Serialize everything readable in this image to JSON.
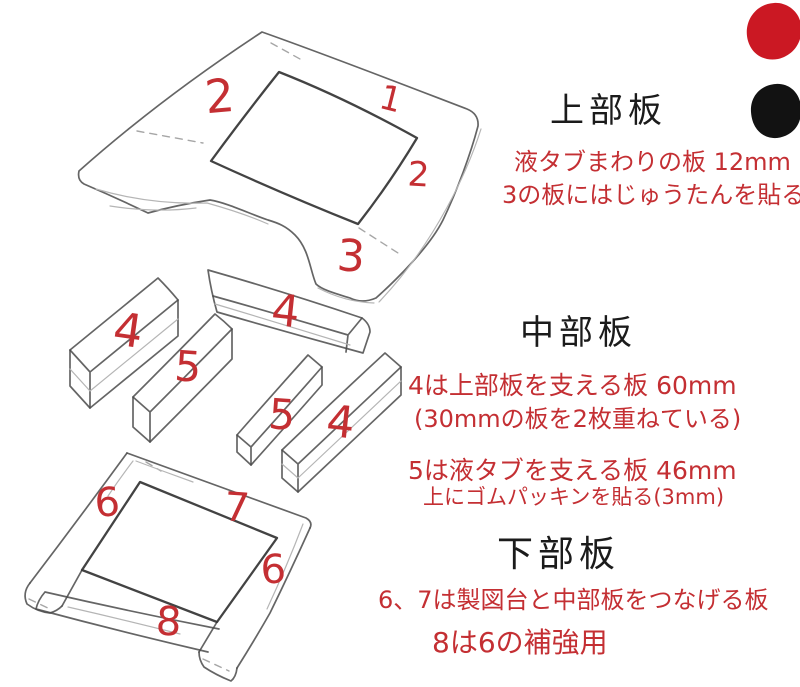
{
  "palette": {
    "background": "#ffffff",
    "pencil": "#4a4a4a",
    "pencil_bold": "#2f2f2f",
    "pencil_light": "#b5b5b5",
    "red_marker": "#c42f33",
    "ink_black": "#1b1b1b",
    "swatch_red": "#cb1823",
    "swatch_black": "#121212"
  },
  "swatches": {
    "red_blob": "red-paint-blob",
    "black_blob": "black-paint-blob"
  },
  "part_labels": [
    {
      "part": "top-board-1",
      "text": "1"
    },
    {
      "part": "top-board-2-left",
      "text": "2"
    },
    {
      "part": "top-board-2-right",
      "text": "2"
    },
    {
      "part": "top-board-3",
      "text": "3"
    },
    {
      "part": "mid-bar-4-left",
      "text": "4"
    },
    {
      "part": "mid-bar-5-left",
      "text": "5"
    },
    {
      "part": "mid-bar-4-cross",
      "text": "4"
    },
    {
      "part": "mid-bar-5-right",
      "text": "5"
    },
    {
      "part": "mid-bar-4-right",
      "text": "4"
    },
    {
      "part": "bottom-bar-6-left",
      "text": "6"
    },
    {
      "part": "bottom-bar-7",
      "text": "7"
    },
    {
      "part": "bottom-bar-6-right",
      "text": "6"
    },
    {
      "part": "bottom-bar-8",
      "text": "8"
    }
  ],
  "sections": {
    "top": {
      "heading": "上部板",
      "line1": "液タブまわりの板 12mm",
      "line2": "3の板にはじゅうたんを貼る"
    },
    "middle": {
      "heading": "中部板",
      "line1": "4は上部板を支える板 60mm",
      "line2": "(30mmの板を2枚重ねている)",
      "line3": "5は液タブを支える板 46mm",
      "line4": "上にゴムパッキンを貼る(3mm)"
    },
    "bottom": {
      "heading": "下部板",
      "line1": "6、7は製図台と中部板をつなげる板",
      "line2": "8は6の補強用"
    }
  }
}
